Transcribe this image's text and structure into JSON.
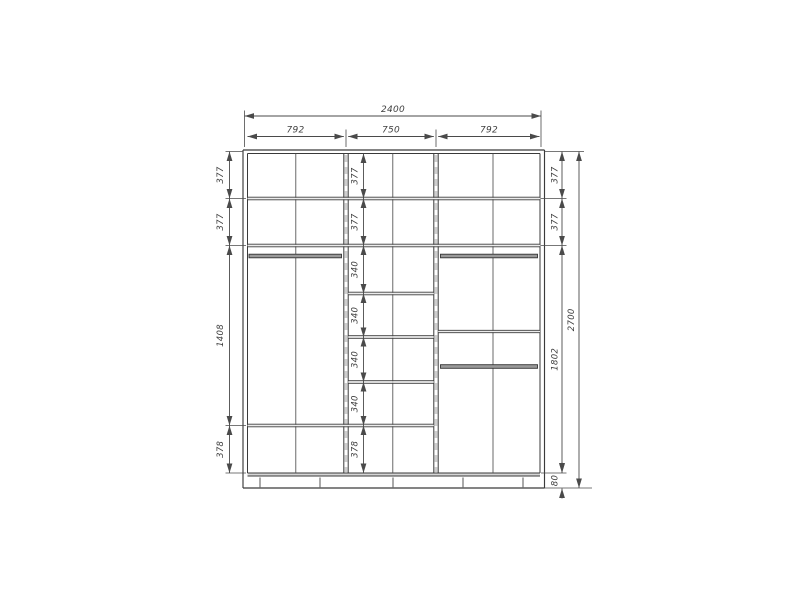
{
  "colors": {
    "background": "#ffffff",
    "line": "#3a3a3a",
    "dim": "#4a4a4a",
    "shelf_fill": "#ececec",
    "rod_fill": "#9a9a9a",
    "dashed_overlay": "#cfcfcf"
  },
  "dims": {
    "top_total": "2400",
    "top_sections": [
      "792",
      "750",
      "792"
    ],
    "left_column": [
      "377",
      "377",
      "1408",
      "378"
    ],
    "center_column": [
      "377",
      "377",
      "340",
      "340",
      "340",
      "340",
      "378"
    ],
    "right_column": [
      "377",
      "377",
      "1802",
      "80"
    ],
    "right_total": "2700"
  }
}
